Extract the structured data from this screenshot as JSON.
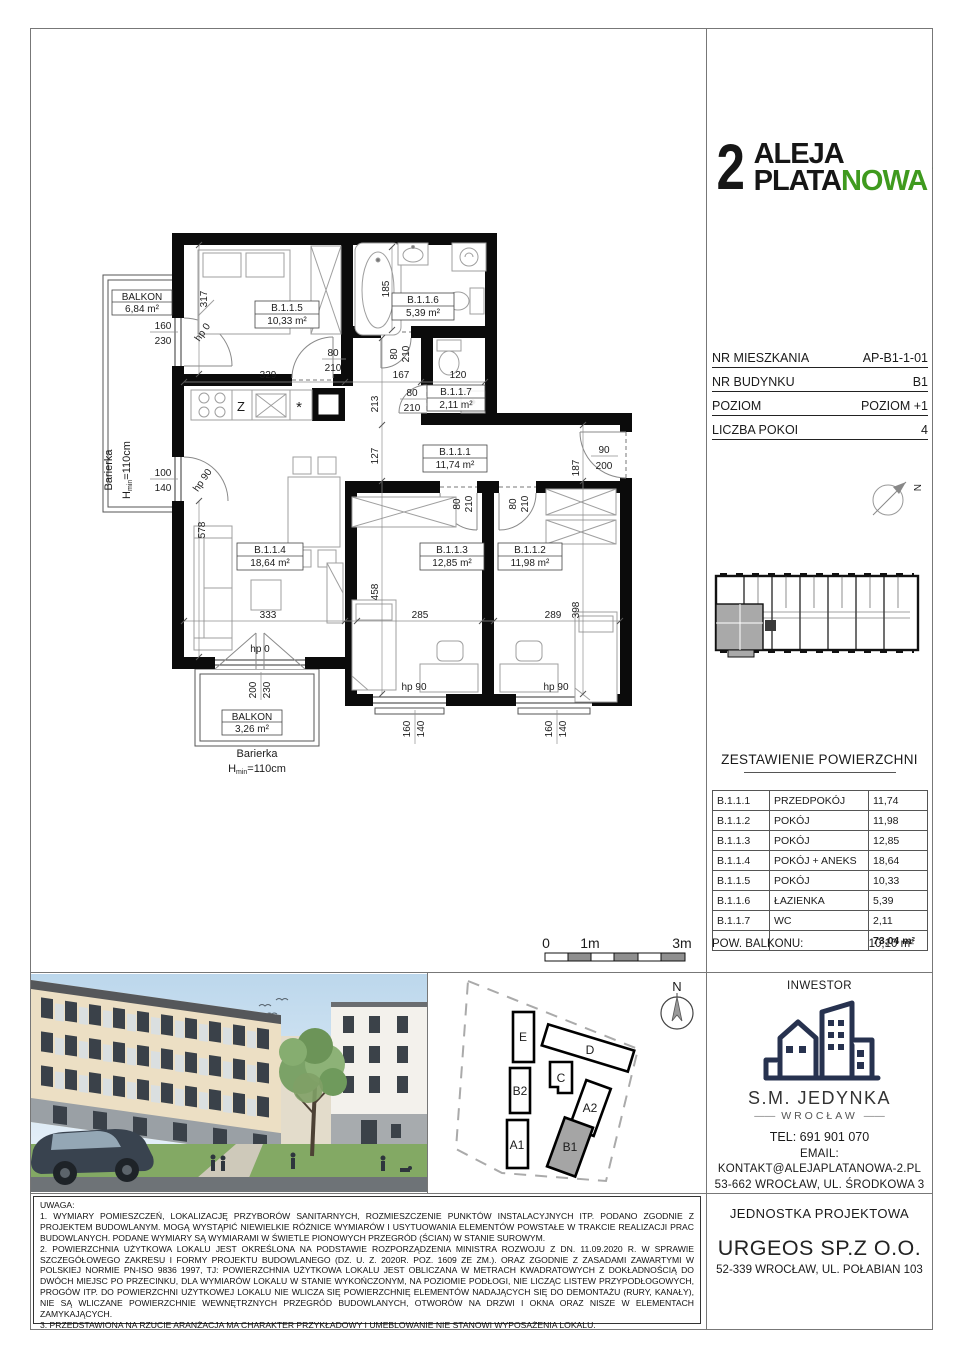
{
  "logo": {
    "number": "2",
    "top": "ALEJA",
    "bottom_black": "PLATA",
    "bottom_green": "NOWA",
    "accent": "#3f9a1e"
  },
  "info": {
    "rows": [
      {
        "label": "NR MIESZKANIA",
        "value": "AP-B1-1-01"
      },
      {
        "label": "NR BUDYNKU",
        "value": "B1"
      },
      {
        "label": "POZIOM",
        "value": "POZIOM +1"
      },
      {
        "label": "LICZBA POKOI",
        "value": "4"
      }
    ]
  },
  "areas": {
    "title": "ZESTAWIENIE POWIERZCHNI",
    "rows": [
      {
        "code": "B.1.1.1",
        "name": "PRZEDPOKÓJ",
        "value": "11,74"
      },
      {
        "code": "B.1.1.2",
        "name": "POKÓJ",
        "value": "11,98"
      },
      {
        "code": "B.1.1.3",
        "name": "POKÓJ",
        "value": "12,85"
      },
      {
        "code": "B.1.1.4",
        "name": "POKÓJ + ANEKS",
        "value": "18,64"
      },
      {
        "code": "B.1.1.5",
        "name": "POKÓJ",
        "value": "10,33"
      },
      {
        "code": "B.1.1.6",
        "name": "ŁAZIENKA",
        "value": "5,39"
      },
      {
        "code": "B.1.1.7",
        "name": "WC",
        "value": "2,11"
      }
    ],
    "total": "73,04 m²",
    "balcony_label": "POW. BALKONU:",
    "balcony_value": "10,10 m²"
  },
  "plan": {
    "rooms": {
      "r1": {
        "id": "B.1.1.1",
        "area": "11,74 m²"
      },
      "r2": {
        "id": "B.1.1.2",
        "area": "11,98 m²"
      },
      "r3": {
        "id": "B.1.1.3",
        "area": "12,85 m²"
      },
      "r4": {
        "id": "B.1.1.4",
        "area": "18,64 m²"
      },
      "r5": {
        "id": "B.1.1.5",
        "area": "10,33 m²"
      },
      "r6": {
        "id": "B.1.1.6",
        "area": "5,39 m²"
      },
      "r7": {
        "id": "B.1.1.7",
        "area": "2,11 m²"
      }
    },
    "balconies": {
      "left": {
        "label": "BALKON",
        "area": "6,84 m²"
      },
      "bottom": {
        "label": "BALKON",
        "area": "3,26 m²"
      }
    },
    "barrier": {
      "word": "Barierka",
      "h": "H",
      "sub": "min",
      "rest": "=110cm"
    },
    "dims": {
      "v317": "317",
      "h329": "329",
      "h167": "167",
      "h120": "120",
      "v185": "185",
      "v213": "213",
      "v127": "127",
      "v458": "458",
      "v578": "578",
      "h333": "333",
      "h285": "285",
      "h289": "289",
      "v187": "187",
      "v398": "398"
    },
    "nums": {
      "n80": "80",
      "n210": "210",
      "n160": "160",
      "n230": "230",
      "n100": "100",
      "n140": "140",
      "n200": "200",
      "n90": "90"
    },
    "hp": {
      "hp0": "hp 0",
      "hp90": "hp 90"
    },
    "kitchen": {
      "z": "Z",
      "star": "*"
    }
  },
  "scale": {
    "t0": "0",
    "t1": "1m",
    "t3": "3m"
  },
  "site": {
    "north": "N",
    "buildings": {
      "e": "E",
      "d": "D",
      "c": "C",
      "b2": "B2",
      "a1": "A1",
      "a2": "A2",
      "b1": "B1"
    }
  },
  "investor": {
    "title": "INWESTOR",
    "name": "S.M. JEDYNKA",
    "dash": "——",
    "city": "WROCŁAW",
    "tel": "TEL: 691 901 070",
    "email_label": "EMAIL:",
    "email": "KONTAKT@ALEJAPLATANOWA-2.PL",
    "address": "53-662 WROCŁAW, UL. ŚRODKOWA 3"
  },
  "designer": {
    "title": "JEDNOSTKA PROJEKTOWA",
    "name": "URGEOS SP.Z O.O.",
    "address": "52-339 WROCŁAW, UL. POŁABIAN 103"
  },
  "notes": {
    "title": "UWAGA:",
    "n1": "1. WYMIARY POMIESZCZEŃ, LOKALIZACJĘ PRZYBORÓW SANITARNYCH, ROZMIESZCZENIE PUNKTÓW INSTALACYJNYCH ITP. PODANO ZGODNIE Z PROJEKTEM BUDOWLANYM. MOGĄ WYSTĄPIĆ NIEWIELKIE RÓŻNICE WYMIARÓW I USYTUOWANIA ELEMENTÓW POWSTAŁE W TRAKCIE REALIZACJI PRAC BUDOWLANYCH. PODANE WYMIARY SĄ WYMIARAMI W ŚWIETLE PIONOWYCH PRZEGRÓD (ŚCIAN) W STANIE SUROWYM.",
    "n2": "2. POWIERZCHNIA UŻYTKOWA LOKALU JEST OKREŚLONA NA PODSTAWIE ROZPORZĄDZENIA MINISTRA ROZWOJU Z DN. 11.09.2020 R. W SPRAWIE SZCZEGÓŁOWEGO ZAKRESU I FORMY PROJEKTU BUDOWLANEGO (DZ. U. Z. 2020R. POZ. 1609 ZE ZM.). ORAZ ZGODNIE Z ZASADAMI ZAWARTYMI W POLSKIEJ NORMIE PN-ISO 9836 1997, TJ: POWIERZCHNIA UŻYTKOWA LOKALU JEST OBLICZANA W METRACH KWADRATOWYCH Z DOKŁADNOŚCIĄ DO DWÓCH MIEJSC PO PRZECINKU, DLA WYMIARÓW LOKALU W STANIE WYKOŃCZONYM, NA POZIOMIE PODŁOGI, NIE LICZĄC LISTEW PRZYPODŁOGOWYCH, PROGÓW ITP. DO POWIERZCHNI UŻYTKOWEJ LOKALU NIE WLICZA SIĘ POWIERZCHNIĘ ELEMENTÓW NADAJĄCYCH SIĘ DO DEMONTAŻU (RURY, KANAŁY), NIE SĄ WLICZANE POWIERZCHNIE WEWNĘTRZNYCH PRZEGRÓD BUDOWLANYCH, OTWORÓW NA DRZWI I OKNA ORAZ NISZE W ELEMENTACH ZAMYKAJĄCYCH.",
    "n3": "3. PRZEDSTAWIONA NA RZUCIE ARANŻACJA MA CHARAKTER PRZYKŁADOWY I UMEBLOWANIE NIE STANOWI WYPOSAŻENIA LOKALU."
  }
}
